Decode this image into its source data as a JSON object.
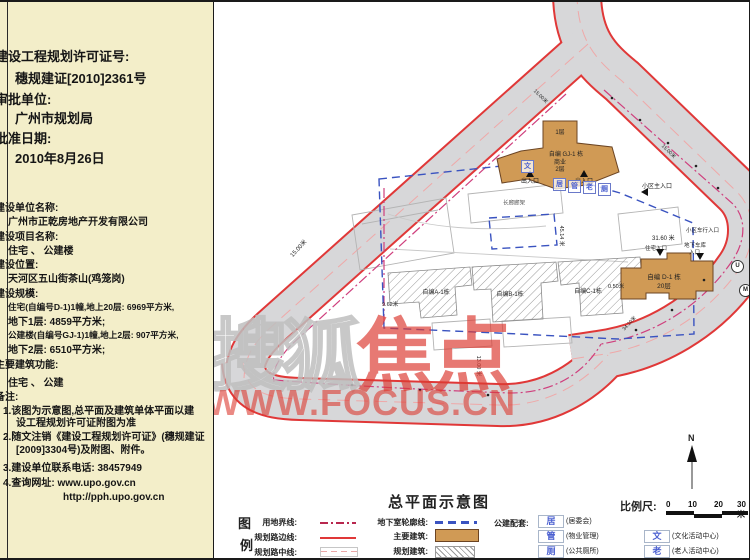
{
  "sidebar": {
    "lines": [
      "建设工程规划许可证号:",
      "穗规建证[2010]2361号",
      "审批单位:",
      "广州市规划局",
      "批准日期:",
      "2010年8月26日",
      "建设单位名称:",
      "广州市正乾房地产开发有限公司",
      "建设项目名称:",
      "住宅 、 公建楼",
      "建设位置:",
      "天河区五山街茶山(鸡笼岗)",
      "建设规模:",
      "住宅(自编号D-1)1幢,地上20层: 6969平方米,",
      "地下1层: 4859平方米;",
      "公建楼(自编号GJ-1)1幢,地上2层: 907平方米,",
      "地下2层: 6510平方米;",
      "主要建筑功能:",
      "住宅 、 公建",
      "备注:",
      "1.该图为示意图,总平面及建筑单体平面以建",
      "设工程规划许可证附图为准",
      "2.随文注销《建设工程规划许可证》(穗规建证",
      "[2009]3304号)及附图、附件。",
      "3.建设单位联系电话: 38457949",
      "4.查询网址: www.upo.gov.cn",
      "http://pph.upo.gov.cn"
    ]
  },
  "map": {
    "buildings": {
      "gj1_name": "自编 GJ-1 栋",
      "gj1_use": "商业",
      "gj1_floors": "2层",
      "gj1_top": "1层",
      "d1_name": "自编 D-1 栋",
      "d1_floors": "20层",
      "a1": "自编A-1栋",
      "b1": "自编B-1栋",
      "c1": "自编C-1栋",
      "corridor": "长廊廊架"
    },
    "entrances": {
      "exit1": "出入口",
      "exit2": "出入口",
      "main": "小区主入口",
      "car": "小区车行入口",
      "residence": "住宅入口",
      "garage_l1": "地下车库",
      "garage_l2": "入口"
    },
    "dimensions": {
      "d31_60": "31.60 米",
      "d0_50": "0.50米",
      "d9_62": "9.62米",
      "d45_14": "45.14 米",
      "d15_00": "15.00米",
      "d13_00": "13.00 米",
      "d34_10": "34.10米",
      "d15_00b": "15.00米",
      "d15_00c": "15.00米"
    },
    "markers": {
      "u": "U",
      "m": "M",
      "north": "N",
      "pub_wen": "文",
      "pub_ju": "居",
      "pub_guan": "管",
      "pub_lao": "老",
      "pub_ce": "厕"
    }
  },
  "watermark": {
    "part1": "搜狐",
    "part2": "焦点",
    "url": "WWW.FOCUS.CN"
  },
  "legend": {
    "title": "总平面示意图",
    "caption1": "图",
    "caption2": "例",
    "scale_label": "比例尺:",
    "scale_ticks": [
      "0",
      "10",
      "20",
      "30米"
    ],
    "items": {
      "boundary": "用地界线:",
      "road_edge": "规划路边线:",
      "road_center": "规划路中线:",
      "basement": "地下室轮廓线:",
      "main_building": "主要建筑:",
      "planned_building": "规划建筑:",
      "public": "公建配套:",
      "ju": "居",
      "ju_desc": "(居委会)",
      "guan": "管",
      "guan_desc": "(物业管理)",
      "ce": "厕",
      "ce_desc": "(公共厕所)",
      "wen": "文",
      "wen_desc": "(文化活动中心)",
      "lao": "老",
      "lao_desc": "(老人活动中心)"
    }
  },
  "colors": {
    "sidebar_bg": "#f3eec9",
    "road_fill": "#d7d7d9",
    "road_edge_red": "#e03838",
    "road_center_pink": "#efa8a8",
    "boundary_magenta": "#cf3f7d",
    "basement_blue": "#3a53c0",
    "building_tan": "#d09a55",
    "building_border": "#6b4423",
    "watermark_red": "#dd3b32",
    "public_char_blue": "#4a5fd0"
  }
}
